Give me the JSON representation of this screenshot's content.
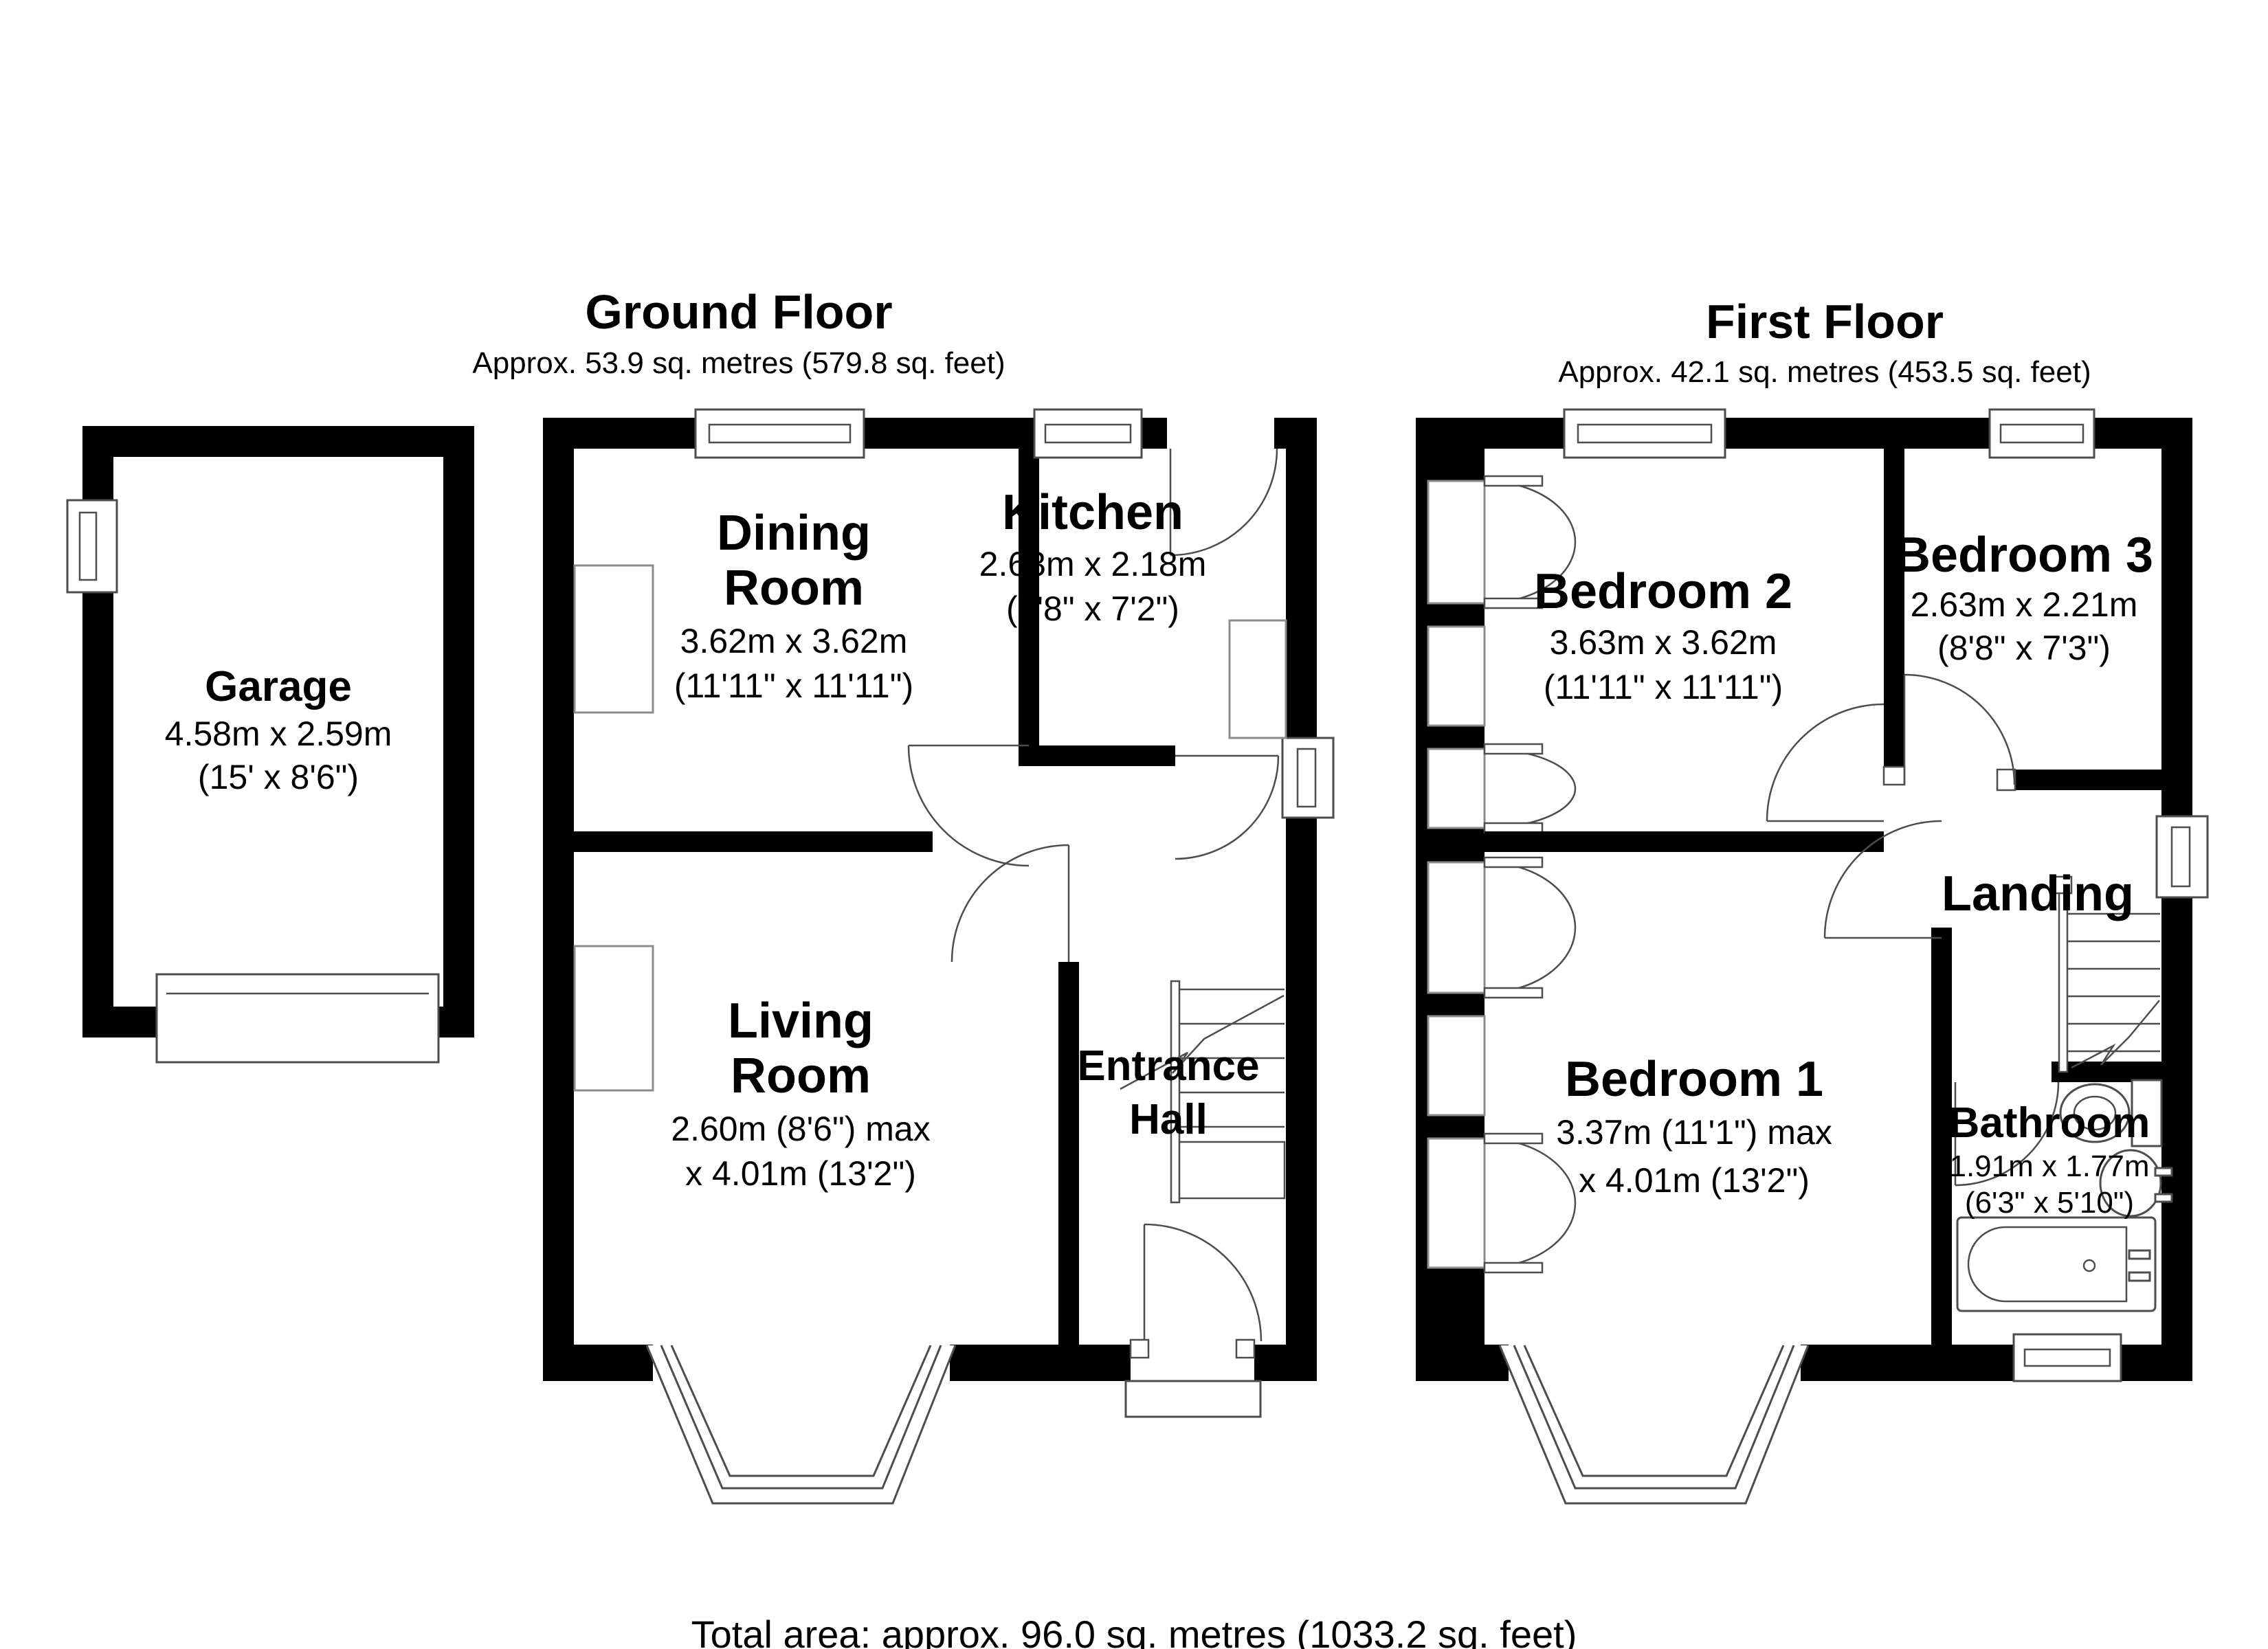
{
  "page": {
    "background": "#ffffff",
    "wall_color": "#000000",
    "line_color": "#4d4d4d",
    "total_area": "Total area: approx. 96.0 sq. metres (1033.2 sq. feet)"
  },
  "garage": {
    "name": "Garage",
    "dims_m": "4.58m x 2.59m",
    "dims_ft": "(15' x 8'6\")"
  },
  "ground_floor": {
    "title": "Ground Floor",
    "area": "Approx. 53.9 sq. metres (579.8 sq. feet)",
    "rooms": {
      "dining": {
        "name": "Dining Room",
        "line1": "Dining",
        "line2": "Room",
        "dims_m": "3.62m x 3.62m",
        "dims_ft": "(11'11\" x 11'11\")"
      },
      "kitchen": {
        "name": "Kitchen",
        "dims_m": "2.63m x 2.18m",
        "dims_ft": "(8'8\" x 7'2\")"
      },
      "living": {
        "name": "Living Room",
        "line1": "Living",
        "line2": "Room",
        "dims_m": "2.60m (8'6\") max",
        "dims_ft": "x 4.01m (13'2\")"
      },
      "hall": {
        "name": "Entrance Hall",
        "line1": "Entrance",
        "line2": "Hall"
      }
    }
  },
  "first_floor": {
    "title": "First Floor",
    "area": "Approx. 42.1 sq. metres (453.5 sq. feet)",
    "rooms": {
      "bedroom2": {
        "name": "Bedroom 2",
        "dims_m": "3.63m x 3.62m",
        "dims_ft": "(11'11\" x 11'11\")"
      },
      "bedroom3": {
        "name": "Bedroom 3",
        "dims_m": "2.63m x 2.21m",
        "dims_ft": "(8'8\" x 7'3\")"
      },
      "bedroom1": {
        "name": "Bedroom 1",
        "dims_m": "3.37m (11'1\") max",
        "dims_ft": "x 4.01m (13'2\")"
      },
      "landing": {
        "name": "Landing"
      },
      "bathroom": {
        "name": "Bathroom",
        "dims_m": "1.91m x 1.77m",
        "dims_ft": "(6'3\" x 5'10\")"
      }
    }
  }
}
